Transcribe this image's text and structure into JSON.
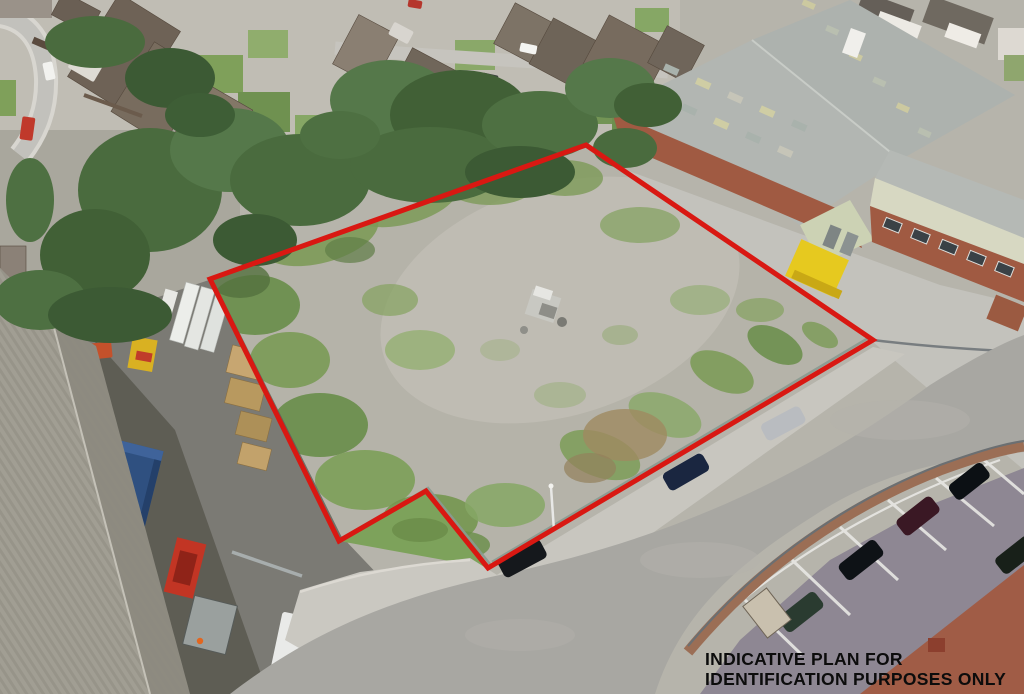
{
  "annotation": {
    "line1": "INDICATIVE PLAN FOR",
    "line2": "IDENTIFICATION PURPOSES ONLY",
    "text_color": "#0c0c0c"
  },
  "boundary": {
    "color": "#d91812",
    "stroke_width": 5
  },
  "palette": {
    "gravel": "#b5b3a9",
    "scrub_green": "#7d9a58",
    "tree_green": "#42603a",
    "road": "#a8a7a2",
    "pavement": "#c9c7c0",
    "brick_wall": "#a05a42",
    "warehouse_roof": "#b2b6b2",
    "pale_green_roof": "#ccd2b4",
    "yellow_container": "#e6c91f",
    "blue_container": "#30517f",
    "corrugated_roof": "#a19e93",
    "depot_tarmac": "#7b7a74",
    "carpark_surface": "#8e8793",
    "carpark_wall": "#9b6e55",
    "red_paving": "#a05c46"
  }
}
